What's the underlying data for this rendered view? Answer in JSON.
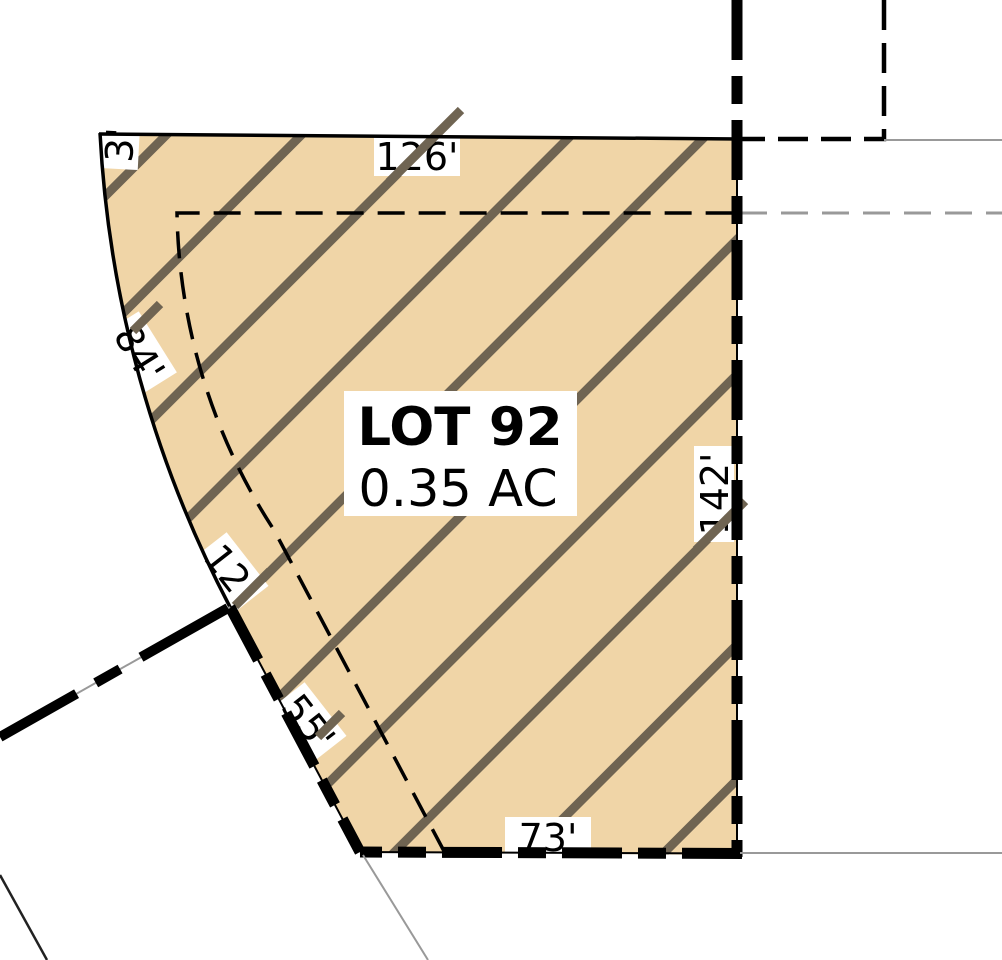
{
  "lot": {
    "name": "LOT 92",
    "area": "0.35 AC"
  },
  "dimensions": {
    "top_edge": "126'",
    "right_edge": "142'",
    "bottom_edge": "73'",
    "lower_left_edge": "55'",
    "arc_segment_lower": "12'",
    "arc_segment_main": "84'",
    "arc_segment_top": "3'"
  },
  "colors": {
    "lot_fill": "#f0d5a7",
    "hatch": "#6f6452",
    "boundary": "#000000",
    "context_line": "#999999",
    "label_bg": "#ffffff",
    "label_text": "#000000"
  }
}
